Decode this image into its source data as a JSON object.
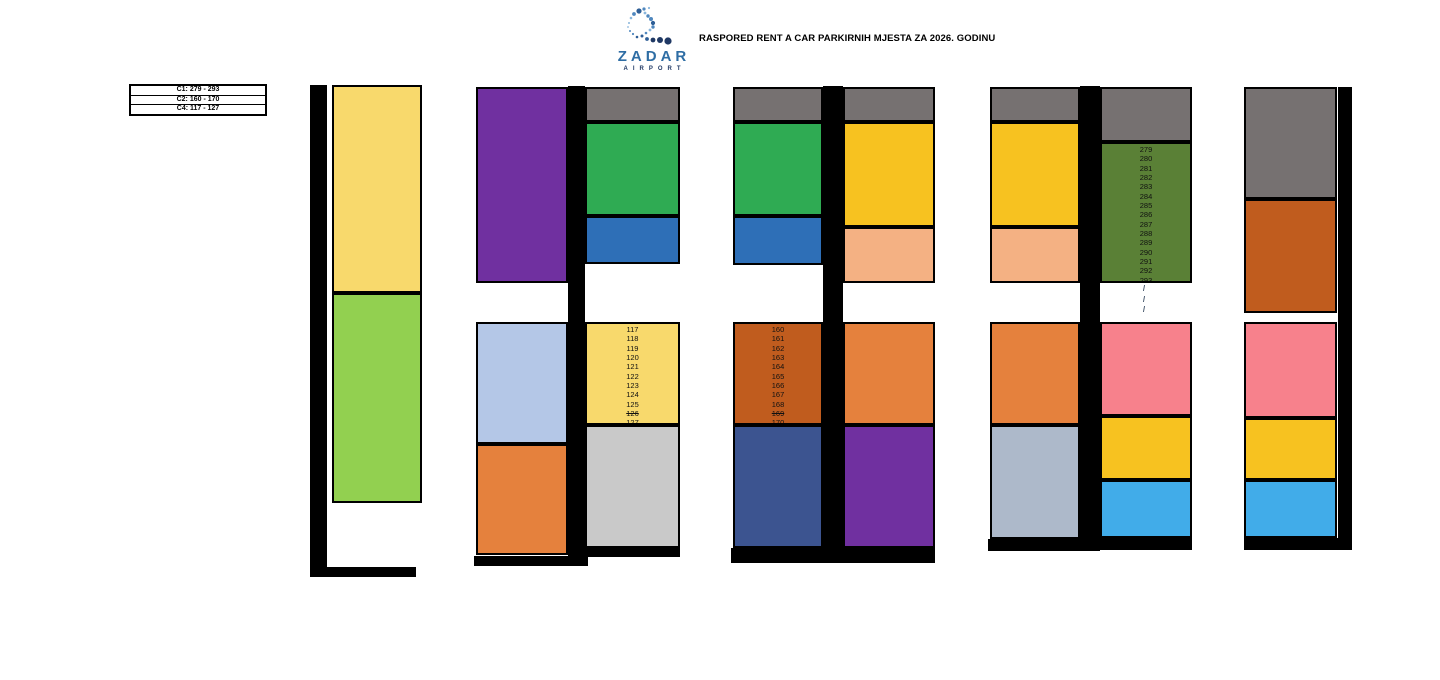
{
  "header": {
    "title": "RASPORED RENT A CAR PARKIRNIH MJESTA ZA 2026. GODINU",
    "logo": {
      "brand": "ZADAR",
      "subtitle": "AIRPORT"
    }
  },
  "legend": {
    "items": [
      {
        "label": "C1: 279 - 293"
      },
      {
        "label": "C2: 160 - 170"
      },
      {
        "label": "C4: 117 - 127"
      }
    ]
  },
  "colors": {
    "light_yellow": "#F8D96C",
    "light_green": "#92D050",
    "purple": "#7030A0",
    "lavender": "#B4C7E7",
    "orange": "#E5813D",
    "gray": "#767171",
    "green": "#2FAB53",
    "blue": "#2E6FB7",
    "light_gray": "#C9C9C9",
    "sienna": "#C05C1E",
    "navy": "#3C5490",
    "amber": "#F7C220",
    "peach": "#F4B183",
    "silver": "#ADB9CA",
    "olive": "#5A8036",
    "pink": "#F7818C",
    "sky": "#41ACE9",
    "bar": "#000000"
  },
  "diagram": {
    "bars": [
      {
        "x": 310,
        "y": 85,
        "w": 17,
        "h": 492
      },
      {
        "x": 310,
        "y": 567,
        "w": 106,
        "h": 10
      },
      {
        "x": 568,
        "y": 86,
        "w": 17,
        "h": 480
      },
      {
        "x": 474,
        "y": 556,
        "w": 114,
        "h": 10
      },
      {
        "x": 585,
        "y": 548,
        "w": 95,
        "h": 9
      },
      {
        "x": 823,
        "y": 86,
        "w": 20,
        "h": 477
      },
      {
        "x": 731,
        "y": 548,
        "w": 93,
        "h": 15
      },
      {
        "x": 843,
        "y": 548,
        "w": 92,
        "h": 15
      },
      {
        "x": 1080,
        "y": 86,
        "w": 20,
        "h": 465
      },
      {
        "x": 988,
        "y": 539,
        "w": 112,
        "h": 12
      },
      {
        "x": 1100,
        "y": 538,
        "w": 92,
        "h": 12
      },
      {
        "x": 1338,
        "y": 87,
        "w": 14,
        "h": 456
      },
      {
        "x": 1244,
        "y": 538,
        "w": 108,
        "h": 12
      }
    ],
    "zones": [
      {
        "id": "g1-yellow",
        "color": "#F8D96C",
        "x": 332,
        "y": 85,
        "w": 90,
        "h": 208
      },
      {
        "id": "g1-green",
        "color": "#92D050",
        "x": 332,
        "y": 293,
        "w": 90,
        "h": 210
      },
      {
        "id": "g2-purple",
        "color": "#7030A0",
        "x": 476,
        "y": 87,
        "w": 92,
        "h": 196
      },
      {
        "id": "g2-lavender",
        "color": "#B4C7E7",
        "x": 476,
        "y": 322,
        "w": 92,
        "h": 122
      },
      {
        "id": "g2-orange",
        "color": "#E5813D",
        "x": 476,
        "y": 444,
        "w": 92,
        "h": 111
      },
      {
        "id": "g2-gray",
        "color": "#767171",
        "x": 585,
        "y": 87,
        "w": 95,
        "h": 35
      },
      {
        "id": "g2-green",
        "color": "#2FAB53",
        "x": 585,
        "y": 122,
        "w": 95,
        "h": 94
      },
      {
        "id": "g2-blue",
        "color": "#2E6FB7",
        "x": 585,
        "y": 216,
        "w": 95,
        "h": 48
      },
      {
        "id": "g2-c4-spots",
        "color": "#F8D96C",
        "x": 585,
        "y": 322,
        "w": 95,
        "h": 103,
        "numbers": [
          "117",
          "118",
          "119",
          "120",
          "121",
          "122",
          "123",
          "124",
          "125",
          "126",
          "127"
        ],
        "struck": [
          "126"
        ]
      },
      {
        "id": "g2-lightgray",
        "color": "#C9C9C9",
        "x": 585,
        "y": 425,
        "w": 95,
        "h": 123
      },
      {
        "id": "g3-gray-left",
        "color": "#767171",
        "x": 733,
        "y": 87,
        "w": 90,
        "h": 35
      },
      {
        "id": "g3-green",
        "color": "#2FAB53",
        "x": 733,
        "y": 122,
        "w": 90,
        "h": 94
      },
      {
        "id": "g3-blue",
        "color": "#2E6FB7",
        "x": 733,
        "y": 216,
        "w": 90,
        "h": 49
      },
      {
        "id": "g3-c2-spots",
        "color": "#C05C1E",
        "x": 733,
        "y": 322,
        "w": 90,
        "h": 103,
        "numbers": [
          "160",
          "161",
          "162",
          "163",
          "164",
          "165",
          "166",
          "167",
          "168",
          "169",
          "170"
        ],
        "struck": [
          "169"
        ]
      },
      {
        "id": "g3-navy",
        "color": "#3C5490",
        "x": 733,
        "y": 425,
        "w": 90,
        "h": 123
      },
      {
        "id": "g3-gray-right",
        "color": "#767171",
        "x": 843,
        "y": 87,
        "w": 92,
        "h": 35
      },
      {
        "id": "g3-amber",
        "color": "#F7C220",
        "x": 843,
        "y": 122,
        "w": 92,
        "h": 105
      },
      {
        "id": "g3-peach",
        "color": "#F4B183",
        "x": 843,
        "y": 227,
        "w": 92,
        "h": 56
      },
      {
        "id": "g3-orange",
        "color": "#E5813D",
        "x": 843,
        "y": 322,
        "w": 92,
        "h": 103
      },
      {
        "id": "g3-purple",
        "color": "#7030A0",
        "x": 843,
        "y": 425,
        "w": 92,
        "h": 123
      },
      {
        "id": "g4-gray-left",
        "color": "#767171",
        "x": 990,
        "y": 87,
        "w": 90,
        "h": 35
      },
      {
        "id": "g4-amber-left",
        "color": "#F7C220",
        "x": 990,
        "y": 122,
        "w": 90,
        "h": 105
      },
      {
        "id": "g4-peach",
        "color": "#F4B183",
        "x": 990,
        "y": 227,
        "w": 90,
        "h": 56
      },
      {
        "id": "g4-orange",
        "color": "#E5813D",
        "x": 990,
        "y": 322,
        "w": 90,
        "h": 103
      },
      {
        "id": "g4-silver",
        "color": "#ADB9CA",
        "x": 990,
        "y": 425,
        "w": 90,
        "h": 114
      },
      {
        "id": "g4-gray-right",
        "color": "#767171",
        "x": 1100,
        "y": 87,
        "w": 92,
        "h": 55
      },
      {
        "id": "g4-c1-spots",
        "color": "#5A8036",
        "x": 1100,
        "y": 142,
        "w": 92,
        "h": 141,
        "numbers": [
          "279",
          "280",
          "281",
          "282",
          "283",
          "284",
          "285",
          "286",
          "287",
          "288",
          "289",
          "290",
          "291",
          "292",
          "293"
        ],
        "struck": []
      },
      {
        "id": "g4-pink",
        "color": "#F7818C",
        "x": 1100,
        "y": 322,
        "w": 92,
        "h": 94
      },
      {
        "id": "g4-amber-right",
        "color": "#F7C220",
        "x": 1100,
        "y": 416,
        "w": 92,
        "h": 64
      },
      {
        "id": "g4-sky",
        "color": "#41ACE9",
        "x": 1100,
        "y": 480,
        "w": 92,
        "h": 58
      },
      {
        "id": "g5-gray",
        "color": "#767171",
        "x": 1244,
        "y": 87,
        "w": 93,
        "h": 112
      },
      {
        "id": "g5-sienna",
        "color": "#C05C1E",
        "x": 1244,
        "y": 199,
        "w": 93,
        "h": 114
      },
      {
        "id": "g5-pink",
        "color": "#F7818C",
        "x": 1244,
        "y": 322,
        "w": 93,
        "h": 96
      },
      {
        "id": "g5-amber",
        "color": "#F7C220",
        "x": 1244,
        "y": 418,
        "w": 93,
        "h": 62
      },
      {
        "id": "g5-sky",
        "color": "#41ACE9",
        "x": 1244,
        "y": 480,
        "w": 93,
        "h": 58
      }
    ],
    "slash_marks": [
      "/",
      "/",
      "/"
    ]
  }
}
